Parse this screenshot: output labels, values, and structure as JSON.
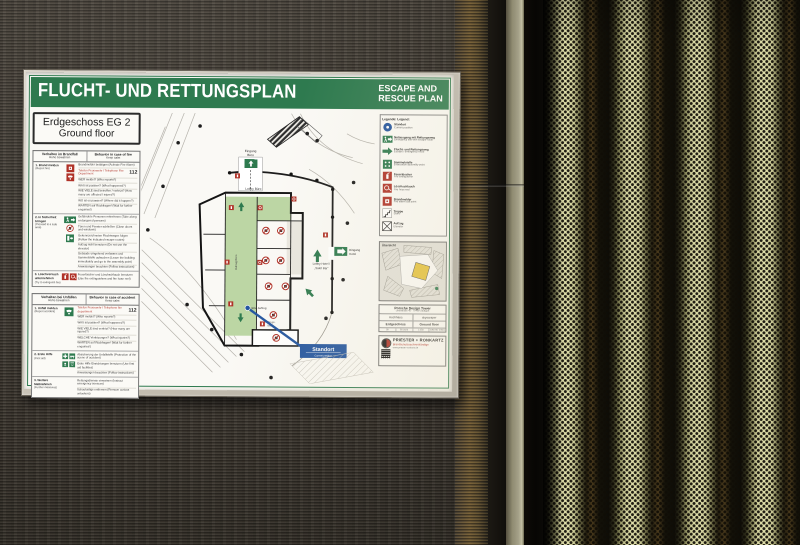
{
  "colors": {
    "sign_green": "#2e7a4f",
    "sign_red": "#b03228",
    "sign_blue": "#2456a0",
    "wall": "#433d35",
    "panel_light": "#dedca6",
    "panel_dark": "#12100a",
    "paper": "#f4f2ec",
    "plan_green": "#bcd6a4",
    "overview_yellow": "#e6c33f"
  },
  "icons": {
    "standort-icon": "blue circle with white dot",
    "emergency-exit-icon": "green sign, running man with arrow",
    "escape-route-arrow-icon": "solid green arrow",
    "assembly-point-icon": "green square with four figures",
    "fire-extinguisher-icon": "red square, white extinguisher",
    "fire-hose-icon": "red square, white hose reel",
    "fire-alarm-icon": "red square, white call point",
    "stairs-icon": "step outline",
    "elevator-icon": "crossed square",
    "no-elevator-icon": "red prohibition circle",
    "phone-icon": "handset glyph",
    "first-aid-icon": "green squares with white cross"
  },
  "b": {
    "title_de": "FLUCHT- UND RETTUNGSPLAN",
    "title_en1": "ESCAPE AND",
    "title_en2": "RESCUE PLAN",
    "floor_de": "Erdgeschoss EG 2",
    "floor_en": "Ground floor",
    "fire": {
      "h_de": "Verhalten im Brandfall",
      "h_de2": "Ruhe bewahren",
      "h_en": "Behavior in case of fire",
      "h_en2": "Keep calm",
      "s1t": "1. Brand melden",
      "s1t2": "(Report fire)",
      "s1l1": "Brandmelder betätigen (Activate Fire Alarm)",
      "s1l2": "Telefon Feuerwehr / Telephone Fire Department",
      "s1n": "112",
      "s1l3": "WER meldet? (Who reports?)",
      "s1l4": "WAS ist passiert? (What happened?)",
      "s1l5": "WIE VIELE sind betroffen / verletzt? (How many are affected / injured?)",
      "s1l6": "WO ist es passiert? (Where did it happen?)",
      "s1l7": "WARTEN auf Rückfragen! (Wait for further enquiries!)",
      "s2t": "2. In Sicherheit bringen",
      "s2t2": "(Proceed to a safe area)",
      "s2l1": "Gefährdete Personen mitnehmen (Take along endangered persons)",
      "s2l2": "Türen und Fenster schließen (Close doors and windows)",
      "s2l3": "Gekennzeichneten Fluchtwegen folgen (Follow the indicated escape routes)",
      "s2l4": "Aufzug nicht benutzen (Do not use the elevator)",
      "s2l5": "Gebäude umgehend verlassen und Sammelstelle aufsuchen (Leave the building immediately and go to the assembly point)",
      "s2l6": "Anweisungen beachten (Follow instructions)",
      "s3t": "3. Löschversuch unternehmen",
      "s3t2": "(Try to extinguish fire)",
      "s3l1": "Feuerlöscher und Löschschlauch benutzen (Use fire extinguishers and fire hose reel)"
    },
    "acc": {
      "h_de": "Verhalten bei Unfällen",
      "h_de2": "Ruhe bewahren",
      "h_en": "Behavior in case of accident",
      "h_en2": "Keep calm",
      "s1t": "1. Unfall melden",
      "s1t2": "(Report accident)",
      "s1l1": "Telefon Feuerwehr / Telephone fire department",
      "s1n": "112",
      "s1l2": "WER meldet? (Who reports?)",
      "s1l3": "WAS ist passiert? (What happened?)",
      "s1l4": "WIE VIELE sind verletzt? (How many are injured?)",
      "s1l5": "WELCHE Verletzungen? (What injuries?)",
      "s1l6": "WARTEN auf Rückfragen! (Wait for further enquiries!)",
      "s2t": "2. Erste Hilfe",
      "s2t2": "(First aid)",
      "s2l1": "Absicherung der Unfallstelle (Protection of the scene of accident)",
      "s2l2": "Erste Hilfe Einrichtungen benutzen (Use first aid facilities)",
      "s2l3": "Anweisungen beachten (Follow instructions)",
      "s3t": "3. Weitere Maßnahmen",
      "s3t2": "(Further measures)",
      "s3l1": "Rettungsdienste einweisen (Instruct emergency services)",
      "s3l2": "Schaulustige entfernen (Remove curious onlookers)"
    },
    "legend": {
      "title": "Legende: Legend:",
      "items": [
        {
          "de": "Standort",
          "en": "Current position"
        },
        {
          "de": "Notausgang mit Rettungsweg",
          "en": "Emergency exit with escape route"
        },
        {
          "de": "Flucht- und Rettungsweg",
          "en": "Escape / emergency route"
        },
        {
          "de": "Sammelstelle",
          "en": "Evacuation assembly point"
        },
        {
          "de": "Feuerlöscher",
          "en": "Fire extinguisher"
        },
        {
          "de": "Löschschlauch",
          "en": "Fire hose reel"
        },
        {
          "de": "Brandmelder",
          "en": "Fire alarm call point"
        },
        {
          "de": "Treppe",
          "en": "Stairs"
        },
        {
          "de": "Aufzug",
          "en": "Elevator"
        }
      ]
    },
    "plan": {
      "eingang_buero1": "Eingang",
      "eingang_buero2": "Büro",
      "lobby_buero": "Lobby Büro",
      "aufzug_buero": "Aufzug Büro",
      "eingang_hotel1": "Eingang",
      "eingang_hotel2": "Hotel",
      "lobby_hotel1": "Lobby Hotel /",
      "lobby_hotel2": "„Salot Bar“",
      "hotel_aufzug": "Hotel Aufzug",
      "aufzugslobby1": "Aufzugs-",
      "aufzugslobby2": "lobby",
      "standort": "Standort",
      "standort_en": "Current position"
    },
    "overview": {
      "label": "Übersicht",
      "name": "Porsche Design Tower",
      "addr1": "Leitzstraße 45",
      "addr2": "70469 Stuttgart"
    },
    "info": {
      "r1a": "Hochhaus",
      "r1b": "skyscraper",
      "r2a": "Erdgeschoss",
      "r2b": "Ground floor",
      "r3a": "00",
      "r3b": "05-2023",
      "r3c": "1:250",
      "r3d": "DIN ISO 23601"
    },
    "footer": {
      "brand": "PRIESTER + RONKARTZ",
      "sub": "Brandschutzsachverständige",
      "line1": "www.priester-ronkartz.de"
    }
  }
}
